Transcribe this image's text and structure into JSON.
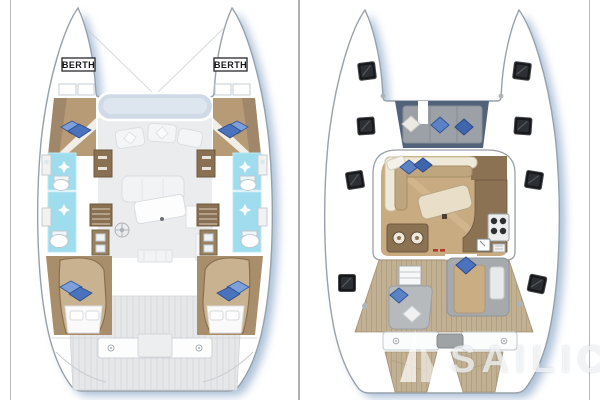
{
  "canvas": {
    "width": 600,
    "height": 400,
    "background": "#ffffff",
    "frame_color": "#b3b6ba"
  },
  "watermark": {
    "brand": "SAILICA",
    "logo": "sail-icon",
    "color": "#ffffff"
  },
  "colors": {
    "hull_shadow_blue": "#9db6d2",
    "hull_outline_gray": "#98a1a9",
    "ghost_floor_gray": "#eaecee",
    "wood_floor_tan": "#b79b77",
    "wood_dark_brown": "#8a7052",
    "bed_mattress_tan": "#c9b28f",
    "bathroom_cyan": "#9edcee",
    "pillow_blue": "#4a72bd",
    "teak_deck": "#c2b092",
    "deck_hatch_black": "#17181a",
    "windshield_blue_gray": "#cfdae6",
    "foredeck_navy_frame": "#51627a",
    "cushion_gray": "#9ba1a7",
    "accent_red": "#b03a2e"
  },
  "left_plan": {
    "name": "catamaran-cabin-deck-plan",
    "berth_label_port": "BERTH",
    "berth_label_starboard": "BERTH",
    "icons": [
      "berth-label",
      "double-bed-icon",
      "pillow-icon",
      "shower-sparkle-icon",
      "toilet-icon",
      "sink-icon",
      "wardrobe-icon",
      "stairs-icon",
      "helm-wheel-icon",
      "dining-table-ghost-icon",
      "cockpit-bench-icon"
    ]
  },
  "right_plan": {
    "name": "catamaran-main-deck-plan",
    "icons": [
      "deck-hatch-icon",
      "foredeck-lounge-icon",
      "pillow-icon",
      "salon-sofa-icon",
      "dining-table-icon",
      "galley-counter-icon",
      "stove-icon",
      "sink-icon",
      "cockpit-steps-icon",
      "cockpit-seat-icon",
      "sunpad-icon",
      "engine-hatch-icon",
      "cockpit-bench-icon",
      "swim-platform-icon",
      "cleat-icon"
    ]
  }
}
